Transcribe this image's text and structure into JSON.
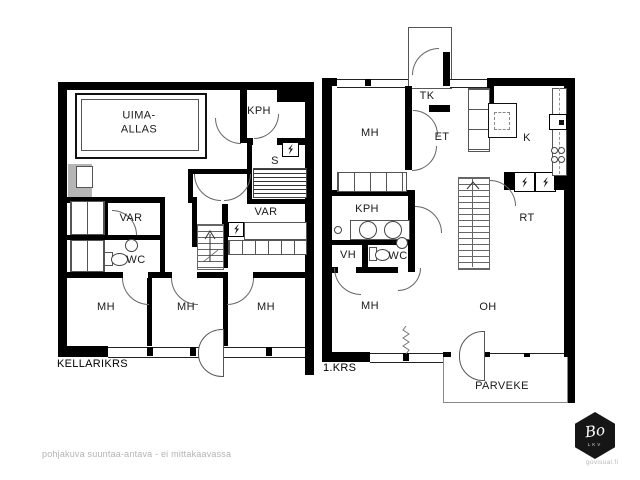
{
  "colors": {
    "wall": "#000000",
    "line": "#555555",
    "fireplace_gray": "#b5b5b5",
    "muted_text": "#b3b3b3"
  },
  "footer": {
    "disclaimer": "pohjakuva suuntaa-antava - ei mittakaavassa"
  },
  "brand": {
    "logo_text": "Bo",
    "logo_sub": "LKV",
    "website": "govisual.fi"
  },
  "basement": {
    "floor_label": "KELLARIKRS",
    "rooms": {
      "pool": "UIMA-\nALLAS",
      "bathroom": "KPH",
      "sauna": "S",
      "storage_left": "VAR",
      "storage_right": "VAR",
      "toilet": "WC",
      "bedroom1": "MH",
      "bedroom2": "MH",
      "bedroom3": "MH"
    }
  },
  "first_floor": {
    "floor_label": "1.KRS",
    "rooms": {
      "entry_porch": "TK",
      "bedroom_top": "MH",
      "hall": "ET",
      "kitchen": "K",
      "bathroom": "KPH",
      "closet": "VH",
      "toilet": "WC",
      "utility": "RT",
      "bedroom_bottom": "MH",
      "living": "OH",
      "balcony": "PARVEKE"
    }
  }
}
